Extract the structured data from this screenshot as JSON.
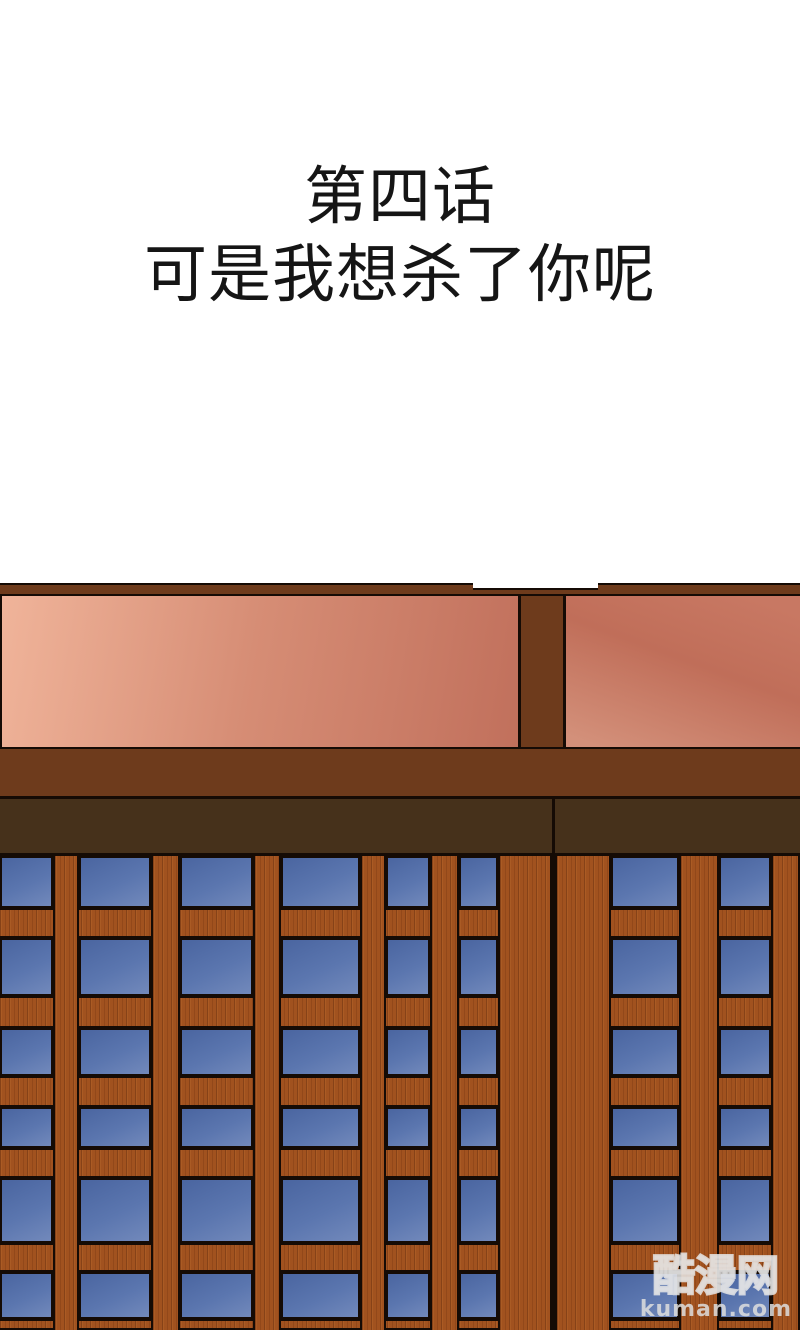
{
  "page": {
    "width": 800,
    "height": 1330,
    "background": "#ffffff"
  },
  "title": {
    "line1": "第四话",
    "line2": "可是我想杀了你呢",
    "color": "#151515"
  },
  "watermark": {
    "brand": "酷漫网",
    "domain": "kuman.com"
  },
  "scene": {
    "colors": {
      "outline": "#150b05",
      "frame": "#6e3b1c",
      "band": "#46311b",
      "wood": "#a1521f",
      "pane_a": "#4a65a0",
      "pane_b": "#5b76af",
      "pane_c": "#7289bb",
      "wall_left_a": "#f0b49a",
      "wall_left_b": "#d68d75",
      "wall_left_c": "#c1705c",
      "wall_right_a": "#c87863",
      "wall_right_b": "#c06e59",
      "wall_right_c": "#d3907a",
      "white": "#ffffff"
    },
    "lintel": {
      "y": 583,
      "h": 13,
      "notch_x": 473,
      "notch_w": 125
    },
    "wall": {
      "y": 596,
      "h": 151,
      "post_x": 518,
      "post_w": 48
    },
    "beam": {
      "y": 747,
      "h": 52
    },
    "band": {
      "y": 799,
      "h": 57
    },
    "divider_x": 552,
    "lattice": {
      "y": 856,
      "h": 474,
      "rails": [
        [
          908,
          938
        ],
        [
          996,
          1028
        ],
        [
          1076,
          1107
        ],
        [
          1148,
          1178
        ],
        [
          1243,
          1272
        ],
        [
          1319,
          1330
        ]
      ],
      "rows": [
        [
          856,
          908
        ],
        [
          938,
          996
        ],
        [
          1028,
          1076
        ],
        [
          1107,
          1148
        ],
        [
          1178,
          1243
        ],
        [
          1272,
          1319
        ]
      ],
      "doors": [
        {
          "x": 0,
          "w": 552,
          "panes": [
            [
              0,
              53
            ],
            [
              79,
              151
            ],
            [
              180,
              253
            ],
            [
              281,
              360
            ],
            [
              386,
              430
            ],
            [
              459,
              498
            ]
          ],
          "mullions": [
            [
              53,
              79
            ],
            [
              151,
              180
            ],
            [
              253,
              281
            ],
            [
              360,
              386
            ],
            [
              430,
              459
            ]
          ],
          "stiles": [
            [
              498,
              552
            ]
          ]
        },
        {
          "x": 555,
          "w": 245,
          "panes": [
            [
              56,
              124
            ],
            [
              164,
              216
            ]
          ],
          "mullions": [
            [
              124,
              164
            ]
          ],
          "stiles": [
            [
              0,
              56
            ],
            [
              216,
              245
            ]
          ]
        }
      ]
    }
  }
}
